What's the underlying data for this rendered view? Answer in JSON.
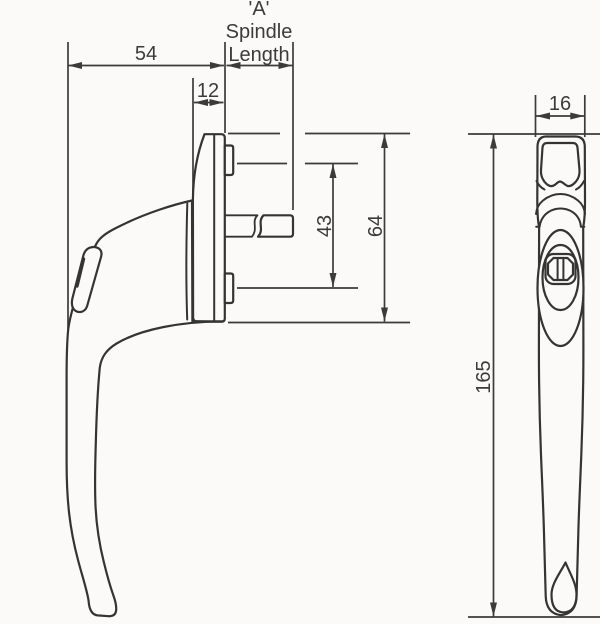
{
  "palette": {
    "background": "#fbfaf8",
    "line": "#343434",
    "text": "#3b3b3b"
  },
  "side_view": {
    "dims": {
      "depth": "54",
      "neck_offset": "12",
      "spindle_inner_height": "43",
      "backplate_height": "64"
    },
    "spindle_label": {
      "line1": "'A'",
      "line2": "Spindle",
      "line3": "Length"
    }
  },
  "front_view": {
    "dims": {
      "width": "16",
      "length": "165"
    }
  }
}
